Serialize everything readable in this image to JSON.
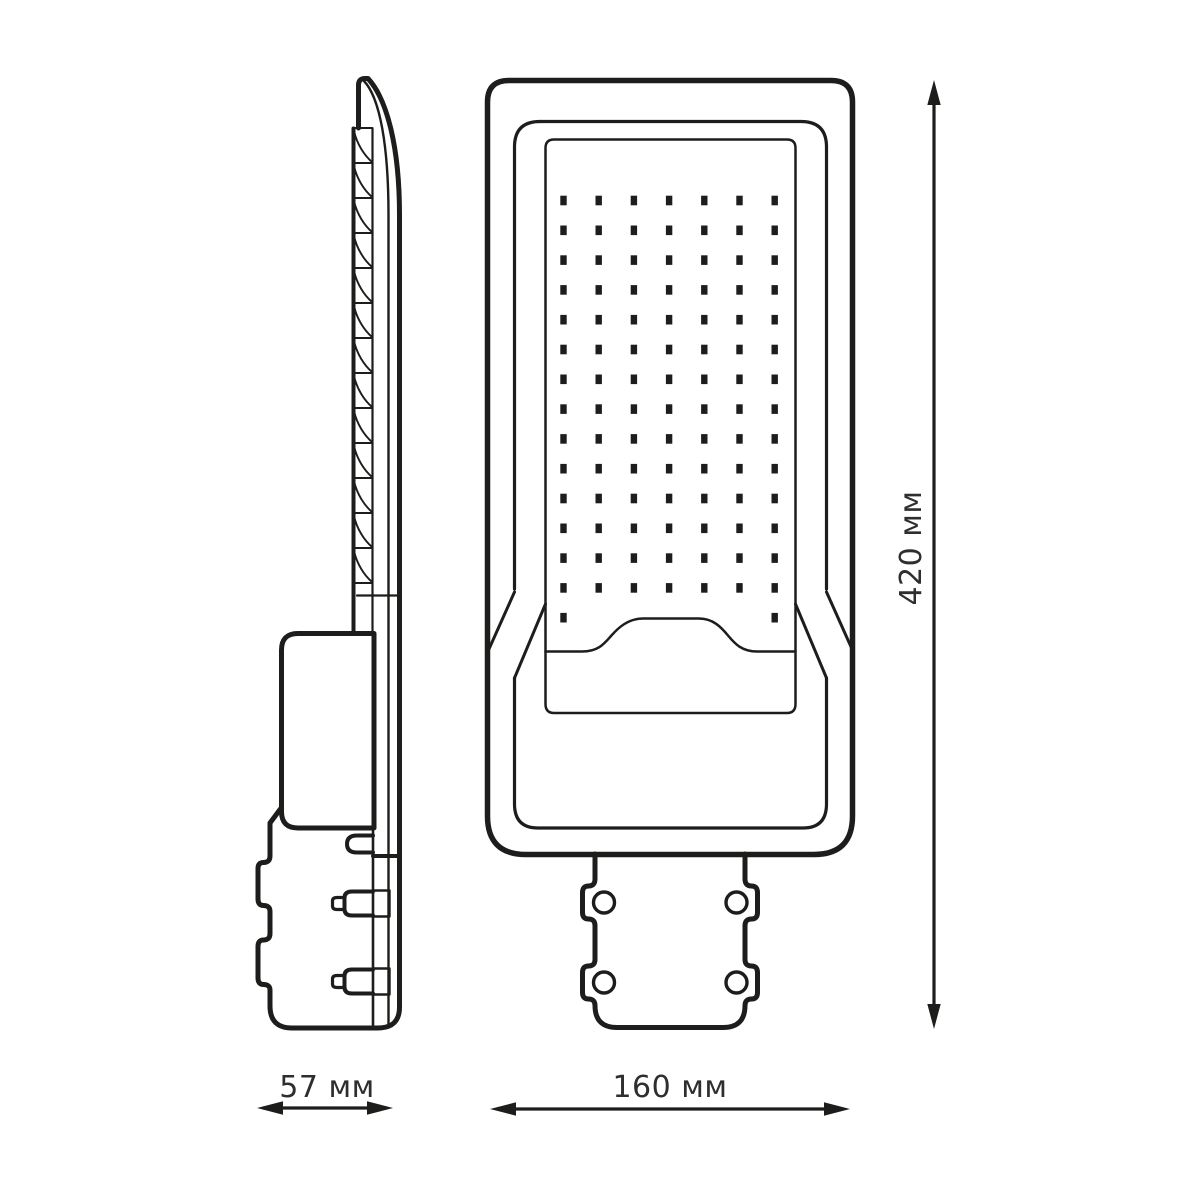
{
  "drawing": {
    "subject": "LED street light luminaire technical drawing, side view and front view",
    "background": "#ffffff",
    "line_color": "#1d1d1b",
    "text_color": "#2e2e2e",
    "font_size_labels": 30,
    "side_view": {
      "fin_count": 13,
      "fin_top_y": 128,
      "fin_pitch": 35
    },
    "front_view": {
      "led_grid": {
        "columns": 7,
        "full_rows": 14,
        "partial_row_columns_present": [
          1,
          7
        ],
        "col_start_x": 563.5,
        "col_pitch": 35.2,
        "row_start_y": 200.5,
        "row_pitch": 29.8,
        "dot_width": 6.4,
        "dot_height": 9.6
      },
      "mount_screw_count": 4
    }
  },
  "dimensions": {
    "height": {
      "label": "420 мм"
    },
    "front_width": {
      "label": "160 мм"
    },
    "side_width": {
      "label": "57 мм"
    }
  }
}
